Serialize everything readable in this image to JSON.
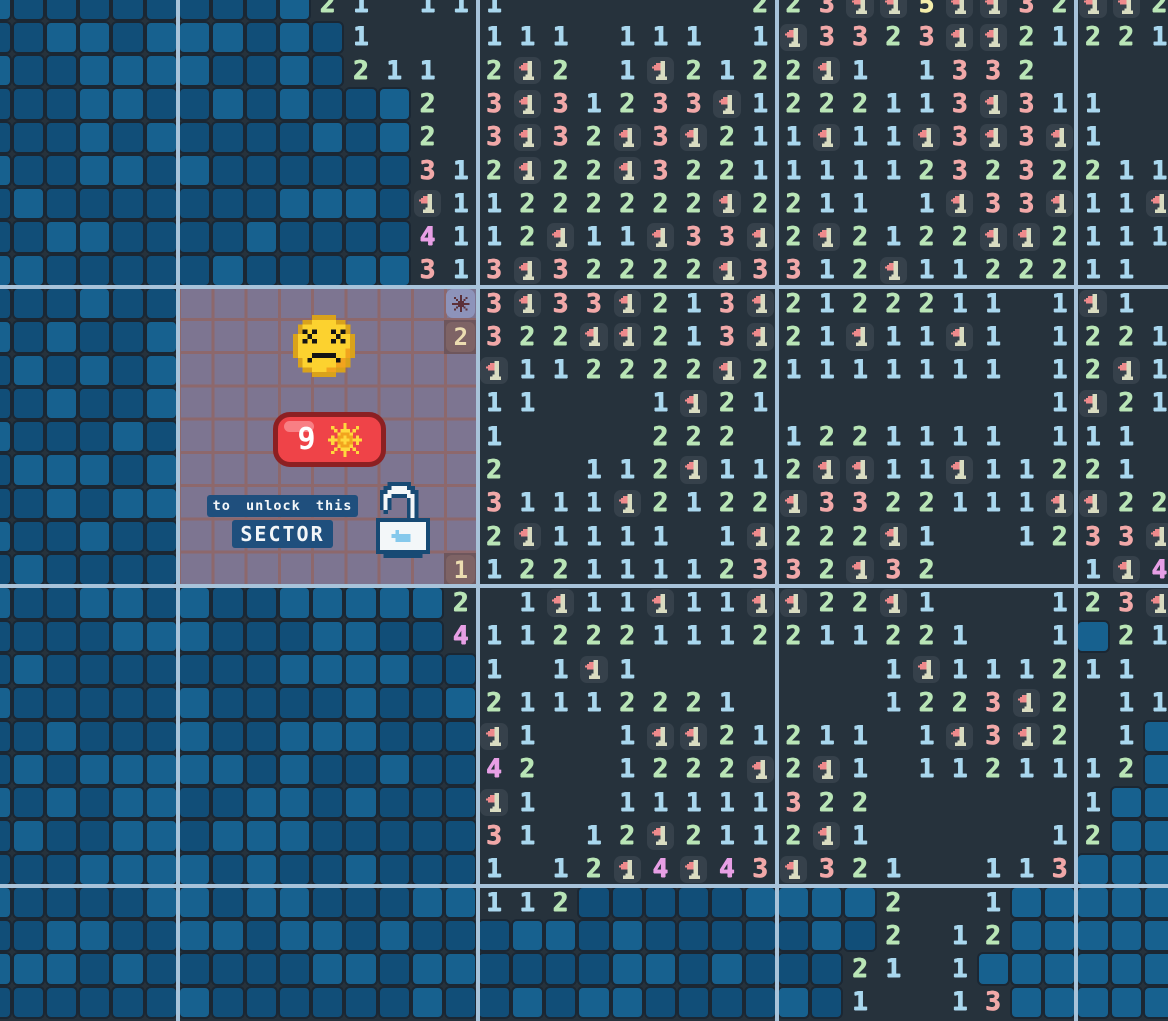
{
  "game": {
    "name": "sector minesweeper",
    "locked_sector": {
      "badge_count": "9",
      "badge_icon": "mine-burst-icon",
      "face_icon": "dead-face-icon",
      "lock_icon": "open-lock-icon",
      "line1": "to unlock this",
      "line2": "SECTOR",
      "bonus_tiles": [
        {
          "row": 9,
          "col": 14,
          "icon": "mine-icon"
        },
        {
          "row": 10,
          "col": 14,
          "value": "2"
        },
        {
          "row": 17,
          "col": 14,
          "value": "1"
        }
      ]
    }
  },
  "board": {
    "cols": 36,
    "rows_count": 31,
    "cell_size": 33.27,
    "origin_x": -21.6,
    "origin_y": -12.4,
    "legend": {
      "B": "unrevealed-blue-tile",
      ".": "revealed-empty",
      "1": "count-1",
      "2": "count-2",
      "3": "count-3",
      "4": "count-4",
      "5": "count-5",
      "F": "flag-on-tile",
      "#": "locked-cell",
      "X": "mine-reward-tile",
      "Y": "bonus-tile-2",
      "Z": "bonus-tile-1"
    },
    "sector_lines": {
      "vertical_x": [
        176,
        475.5,
        775,
        1074.3
      ],
      "horizontal_y": [
        285,
        584.4,
        883.9
      ]
    },
    "rows": [
      "BBBBBBBBBB21.111.......223FF5FF32FF2",
      "BBBBBBBBBBB1...111.111.1F3323FF21221",
      "BBBBBBBBBBB211.2F2.1F2122F1.1332....",
      "BBBBBBBBBBBBB2.3F31233F1222113F311..",
      "BBBBBBBBBBBBB2.3F32F3F211F11F3F3F1..",
      "BBBBBBBBBBBBB312F22F3221111123232211",
      "BBBBBBBBBBBBBF11222222F2211.1F33F11F",
      "BBBBBBBBBBBBB4112F11F33F2F2122FF2111",
      "BBBBBBBBBBBBB313F32222F3312F1122211.",
      "BBBBBB########X3F33F213F2122211.1F1.",
      "BBBBBB########Y322FF213F21F11F1.1221",
      "BBBBBB#########F112222F21111111.12F1",
      "BBBBBB#########11...1F21........1F21",
      "BBBBBB#########1....222.1221111.111.",
      "BBBBBB#########2..112F112FF11F11221.",
      "BBBBBB#########3111F2122F3322111FF22",
      "BBBBBB#########2F1111.1F222F1..1233F",
      "BBBBBB########Z12211112332F32....1F4",
      "BBBBBBBBBBBBBB2.1F11F11FF22F1...123F",
      "BBBBBBBBBBBBBB4112221112211221..1B21",
      "BBBBBBBBBBBBBBB1.1F1.......1F111211.",
      "BBBBBBBBBBBBBBB21112221....1223F2.11",
      "BBBBBBBBBBBBBBBF1..1FF21211.1F3F2.1B",
      "BBBBBBBBBBBBBBB42..1222F2F1.1121112B",
      "BBBBBBBBBBBBBBBF1..11111322......1BB",
      "BBBBBBBBBBBBBBB31.12F2112F1.....12BB",
      "BBBBBBBBBBBBBBB1.12F4F43F321..113BBB",
      "BBBBBBBBBBBBBBB112BBBBBBBBB2..1BBBBB",
      "BBBBBBBBBBBBBBBBBBBBBBBBBBB2.12BBBBB",
      "BBBBBBBBBBBBBBBBBBBBBBBBBB21.1BBBBBB",
      "BBBBBBBBBBBBBBBBBBBBBBBBBB1..13BBBBB"
    ]
  },
  "colors": {
    "board_bg": "#26323c",
    "blue_tile": "#114e78",
    "blue_tile_light": "#17618f",
    "digit_1": "#a9d7ee",
    "digit_2": "#b9e5b6",
    "digit_3": "#f1a8a8",
    "digit_4": "#e79fe5",
    "digit_5": "#f3edaa",
    "flag": "#ee8a8c",
    "flag_pole": "#d9dcc1",
    "overlay": "#7d7591",
    "overlay_grid": "#8d686c",
    "sector_line": "#a8c3da",
    "badge_red": "#ef4348",
    "badge_border": "#8c2022",
    "chip_blue": "#1f4f7d",
    "face_yellow": "#fcd22f",
    "lock_blue": "#174a74"
  }
}
